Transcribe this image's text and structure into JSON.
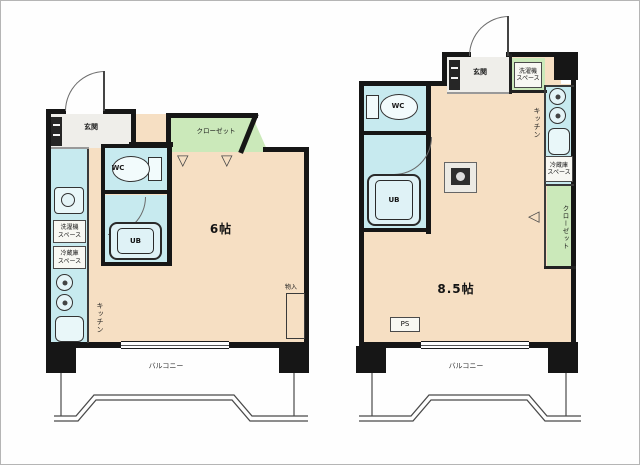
{
  "colors": {
    "floor": "#f6dfc3",
    "wet_area": "#c7eaef",
    "closet": "#cbe9ba",
    "entrance_floor": "#efeeea",
    "wall": "#161616"
  },
  "unit_left": {
    "entrance": "玄関",
    "wc": "WC",
    "bath": "UB",
    "closet": "クローゼット",
    "washer_space_line1": "洗濯機",
    "washer_space_line2": "スペース",
    "fridge_space_line1": "冷蔵庫",
    "fridge_space_line2": "スペース",
    "kitchen": "キッチン",
    "room_size": "6帖",
    "storage": "物入",
    "balcony": "バルコニー",
    "folding_door_glyph": "▽"
  },
  "unit_right": {
    "entrance": "玄関",
    "wc": "WC",
    "bath": "UB",
    "closet": "クローゼット",
    "washer_space_line1": "洗濯機",
    "washer_space_line2": "スペース",
    "fridge_space_line1": "冷蔵庫",
    "fridge_space_line2": "スペース",
    "kitchen": "キッチン",
    "room_size": "8.5帖",
    "pipe_space": "PS",
    "balcony": "バルコニー",
    "folding_door_glyph": "◁"
  }
}
